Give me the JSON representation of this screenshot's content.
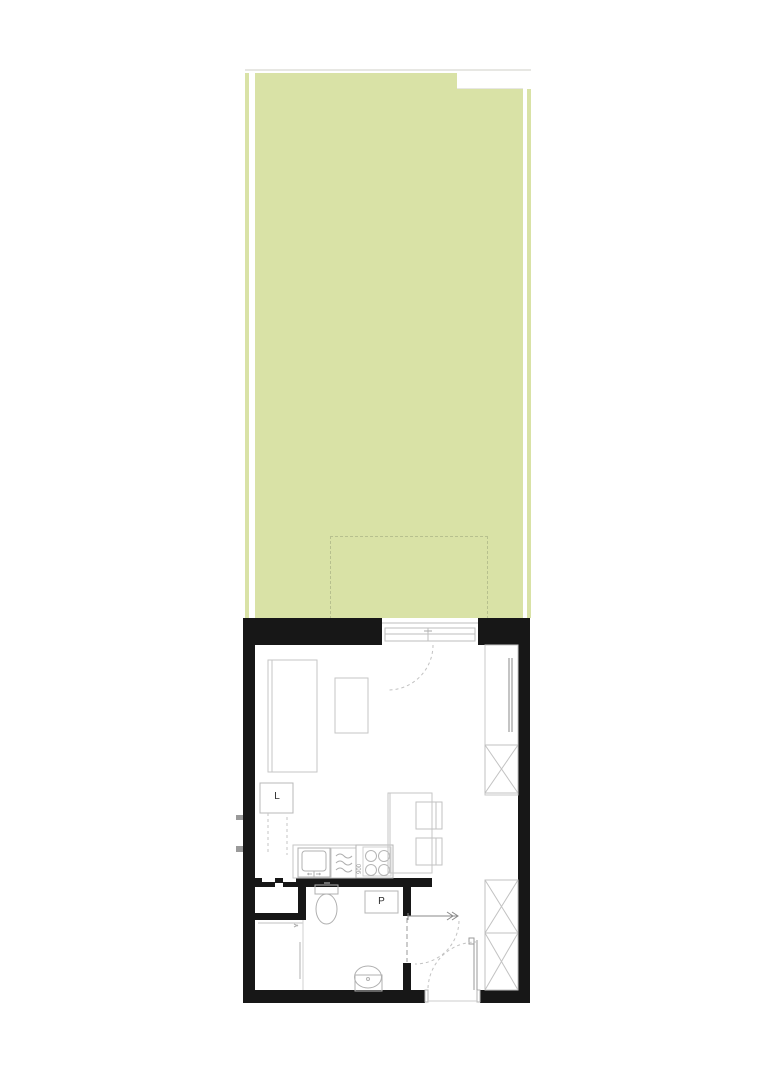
{
  "plan": {
    "type": "apartment-floor-plan",
    "labels": {
      "fridge": "L",
      "washer": "P",
      "stove_dimension": "900"
    },
    "colors": {
      "garden_green": "#d9e2a6",
      "terrace_dash": "#b7c08e",
      "wall_black": "#171717",
      "furniture_light_gray": "#c6c6c6",
      "furniture_mid_gray": "#b0b0b0",
      "furniture_dark_gray": "#8a8a8a",
      "background": "#ffffff"
    },
    "icons": [
      "bed-icon",
      "side-table-icon",
      "fridge-box",
      "kitchen-counter",
      "sink-icon",
      "dishwasher-icon",
      "stove-icon",
      "island-counter",
      "stool-icon",
      "wardrobe-icon",
      "sliding-doors-icon",
      "toilet-icon",
      "washing-machine-box",
      "washbasin-icon",
      "balcony-door-icon",
      "entry-door-icon",
      "entry-arrow-icon",
      "terrace-outline",
      "garden-area"
    ]
  }
}
